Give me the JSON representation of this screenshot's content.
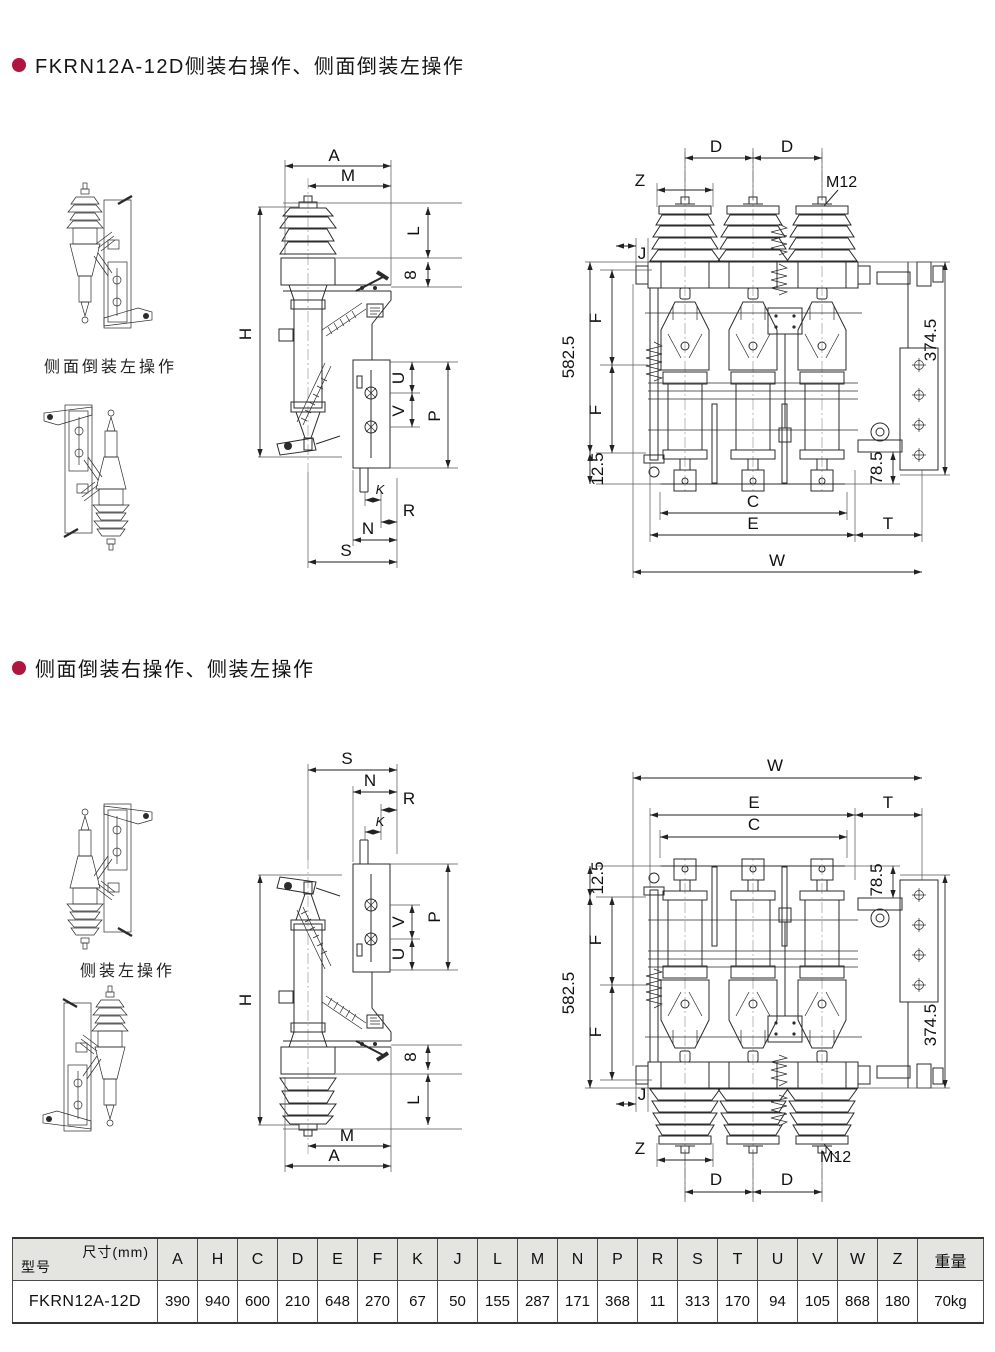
{
  "page": {
    "bg": "#ffffff",
    "accent": "#b0153f",
    "line_color": "#2b2b2b"
  },
  "sections": {
    "s1": {
      "title": "FKRN12A-12D侧装右操作、侧面倒装左操作",
      "caption": "侧面倒装左操作"
    },
    "s2": {
      "title": "侧面倒装右操作、侧装左操作",
      "caption": "侧装左操作"
    }
  },
  "dims": {
    "A": "A",
    "M": "M",
    "L": "L",
    "n8": "8",
    "H": "H",
    "U": "U",
    "V": "V",
    "P": "P",
    "K": "K",
    "R": "R",
    "N": "N",
    "S": "S",
    "D": "D",
    "Z": "Z",
    "M12": "M12",
    "J": "J",
    "F": "F",
    "C": "C",
    "E": "E",
    "T": "T",
    "W": "W",
    "d582": "582.5",
    "d125": "12.5",
    "d3745": "374.5",
    "d785": "78.5"
  },
  "table": {
    "corner_top": "尺寸(mm)",
    "corner_bottom": "型号",
    "columns": [
      "A",
      "H",
      "C",
      "D",
      "E",
      "F",
      "K",
      "J",
      "L",
      "M",
      "N",
      "P",
      "R",
      "S",
      "T",
      "U",
      "V",
      "W",
      "Z",
      "重量"
    ],
    "rows": [
      {
        "model": "FKRN12A-12D",
        "values": [
          "390",
          "940",
          "600",
          "210",
          "648",
          "270",
          "67",
          "50",
          "155",
          "287",
          "171",
          "368",
          "11",
          "313",
          "170",
          "94",
          "105",
          "868",
          "180",
          "70kg"
        ]
      }
    ]
  }
}
